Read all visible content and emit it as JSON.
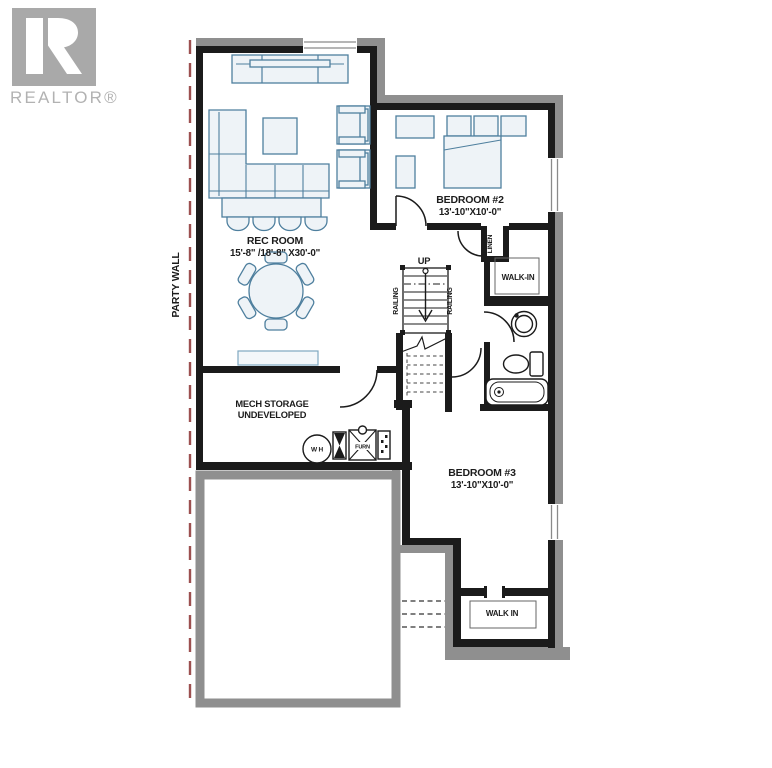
{
  "branding": {
    "logo_text": "REALTOR®"
  },
  "annotations": {
    "party_wall": "PARTY WALL"
  },
  "rooms": {
    "rec_room": {
      "name": "REC ROOM",
      "dims": "15'-8\" /18'-8\" X30'-0\""
    },
    "bedroom_2": {
      "name": "BEDROOM #2",
      "dims": "13'-10\"X10'-0\""
    },
    "bedroom_3": {
      "name": "BEDROOM #3",
      "dims": "13'-10\"X10'-0\""
    },
    "mech_storage": {
      "name": "MECH STORAGE",
      "status": "UNDEVELOPED"
    },
    "walk_in_bedroom2": {
      "name": "WALK-IN"
    },
    "walk_in_bedroom3": {
      "name": "WALK IN"
    },
    "linen": {
      "name": "LINEN"
    }
  },
  "stairs": {
    "direction": "UP",
    "railing_left": "RAILING",
    "railing_right": "RAILING"
  },
  "equipment": {
    "water_heater": "W H",
    "furnace": "FURN"
  },
  "colors": {
    "wall_black": "#1b1b1b",
    "wall_gray": "#8f8f8f",
    "furniture_stroke": "#4e7f9e",
    "furniture_fill": "#eef3f7",
    "party_wall_line": "#9c5050",
    "logo_gray": "#a9a9a9",
    "text": "#1c1c1c"
  }
}
